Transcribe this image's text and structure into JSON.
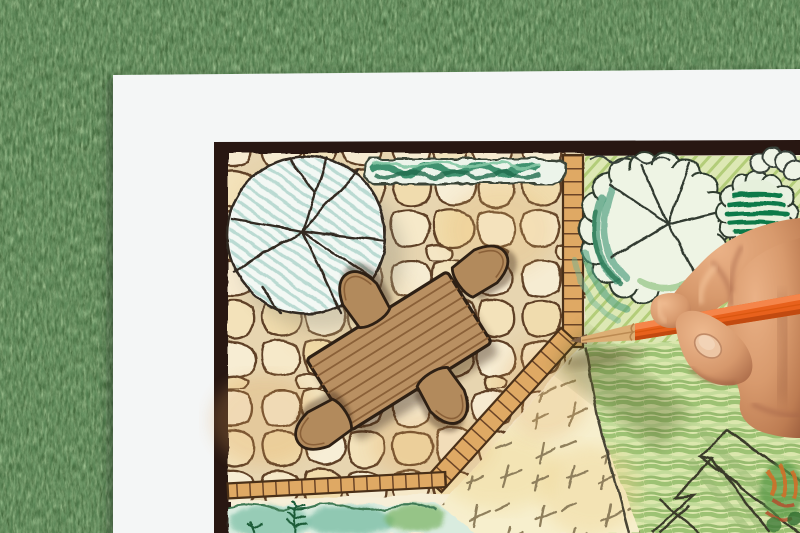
{
  "scene": {
    "kind": "photo",
    "description": "Top-down photo of a hand holding an orange colored pencil, drawing a garden landscape architecture plan on white paper lying on green grass",
    "objects": {
      "background": "artificial-grass",
      "paper": "white-sheet",
      "plan": "garden-design-drawing",
      "plan_items": [
        "deciduous-tree-symbol-left",
        "hedge-strip",
        "flagstone-patio",
        "wood-table",
        "chairs-4",
        "brick-edging",
        "pale-lawn-dashes",
        "striped-lawn",
        "tree-symbol-right",
        "dark-shrub",
        "planting-bed-zigzag",
        "fern-bed"
      ],
      "hand": "right-hand-holding-pencil",
      "pencil": "orange-colored-pencil"
    }
  },
  "colors": {
    "grass_base": "#44683c",
    "grass_light": "#8cc773",
    "paper": "#f4f6f6",
    "frame": "#281712",
    "plan_paper": "#f7efd8",
    "stone_mortar": "#e7d5b0",
    "stone_light": "#f6ecd2",
    "stone_mid": "#f2e3bd",
    "stone_dark": "#f0dcae",
    "stone_line": "#5f4126",
    "patio_tint": "#e8b96f",
    "edging": "#dfa964",
    "edging_line": "#6b4426",
    "hedge_fill": "#ecf4ea",
    "hedge_green": "#2f8763",
    "hedge_dark": "#1f6b4c",
    "hedge_light": "#84c7a4",
    "tree_fill": "#f3f8f4",
    "tree_hatch": "#b7d8d0",
    "tree_line": "#322a20",
    "crown_fill": "#eef4e4",
    "crown_teal": "#4f9e7d",
    "crown_teal_dark": "#2b7a58",
    "shrub_green": "#117a4a",
    "planting_base": "#dde8b4",
    "planting_hatch": "#a6c465",
    "lawn_stripe": "#9dc274",
    "lawn_stripe_light": "#c3db9a",
    "pale_lawn": "#f7efcd",
    "dash_mark": "#8f7f5c",
    "bed_base": "#d9ecdf",
    "bed_teal": "#8cc7b0",
    "bed_green": "#7ab464",
    "fern": "#1d5c38",
    "table_wood": "#b99062",
    "table_line": "#2e2014",
    "plank_line": "#8a6038",
    "chair_fill": "#b28a5c",
    "skin_light": "#eab186",
    "skin_mid": "#d89a6d",
    "skin_deep": "#9a5c3c",
    "nail": "#edc6a4",
    "pencil_orange": "#e8611c",
    "pencil_highlight": "#f5854a",
    "pencil_shade": "#c24a10",
    "pencil_wood": "#dcae74",
    "pencil_lead": "#7d5f45"
  }
}
